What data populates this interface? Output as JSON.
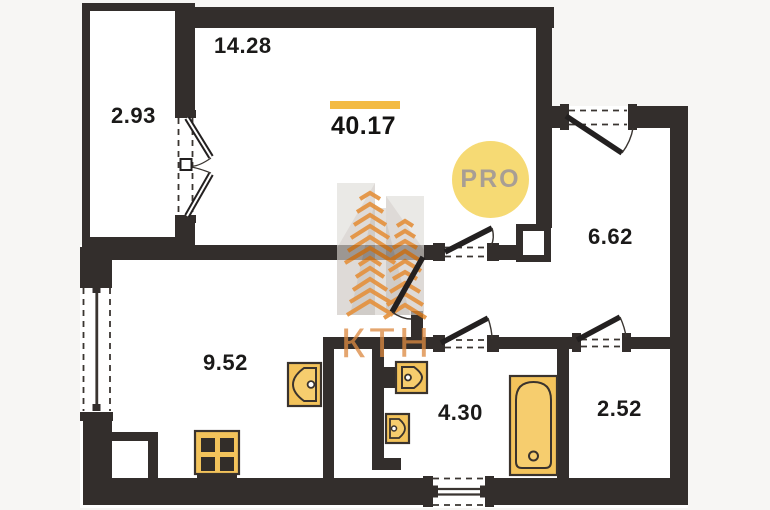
{
  "plan": {
    "type": "apartment-floor-plan",
    "areas": {
      "living": "14.28",
      "balcony": "2.93",
      "hall": "6.62",
      "kitchen": "9.52",
      "bath": "4.30",
      "storage": "2.52",
      "total": "40.17"
    }
  },
  "badge": {
    "label": "PRO"
  },
  "watermark": {
    "text": "КТН"
  },
  "colors": {
    "wall": "#332e2c",
    "fixture_fill": "#f3c35b",
    "fixture_stroke": "#3a332d",
    "accent_bar": "#f3bb44",
    "badge_fill": "#f6da74",
    "badge_text": "#a89e94",
    "watermark_orange": "#df7f1e",
    "watermark_gray": "#cfcac5",
    "label_text": "#1b1a19"
  }
}
